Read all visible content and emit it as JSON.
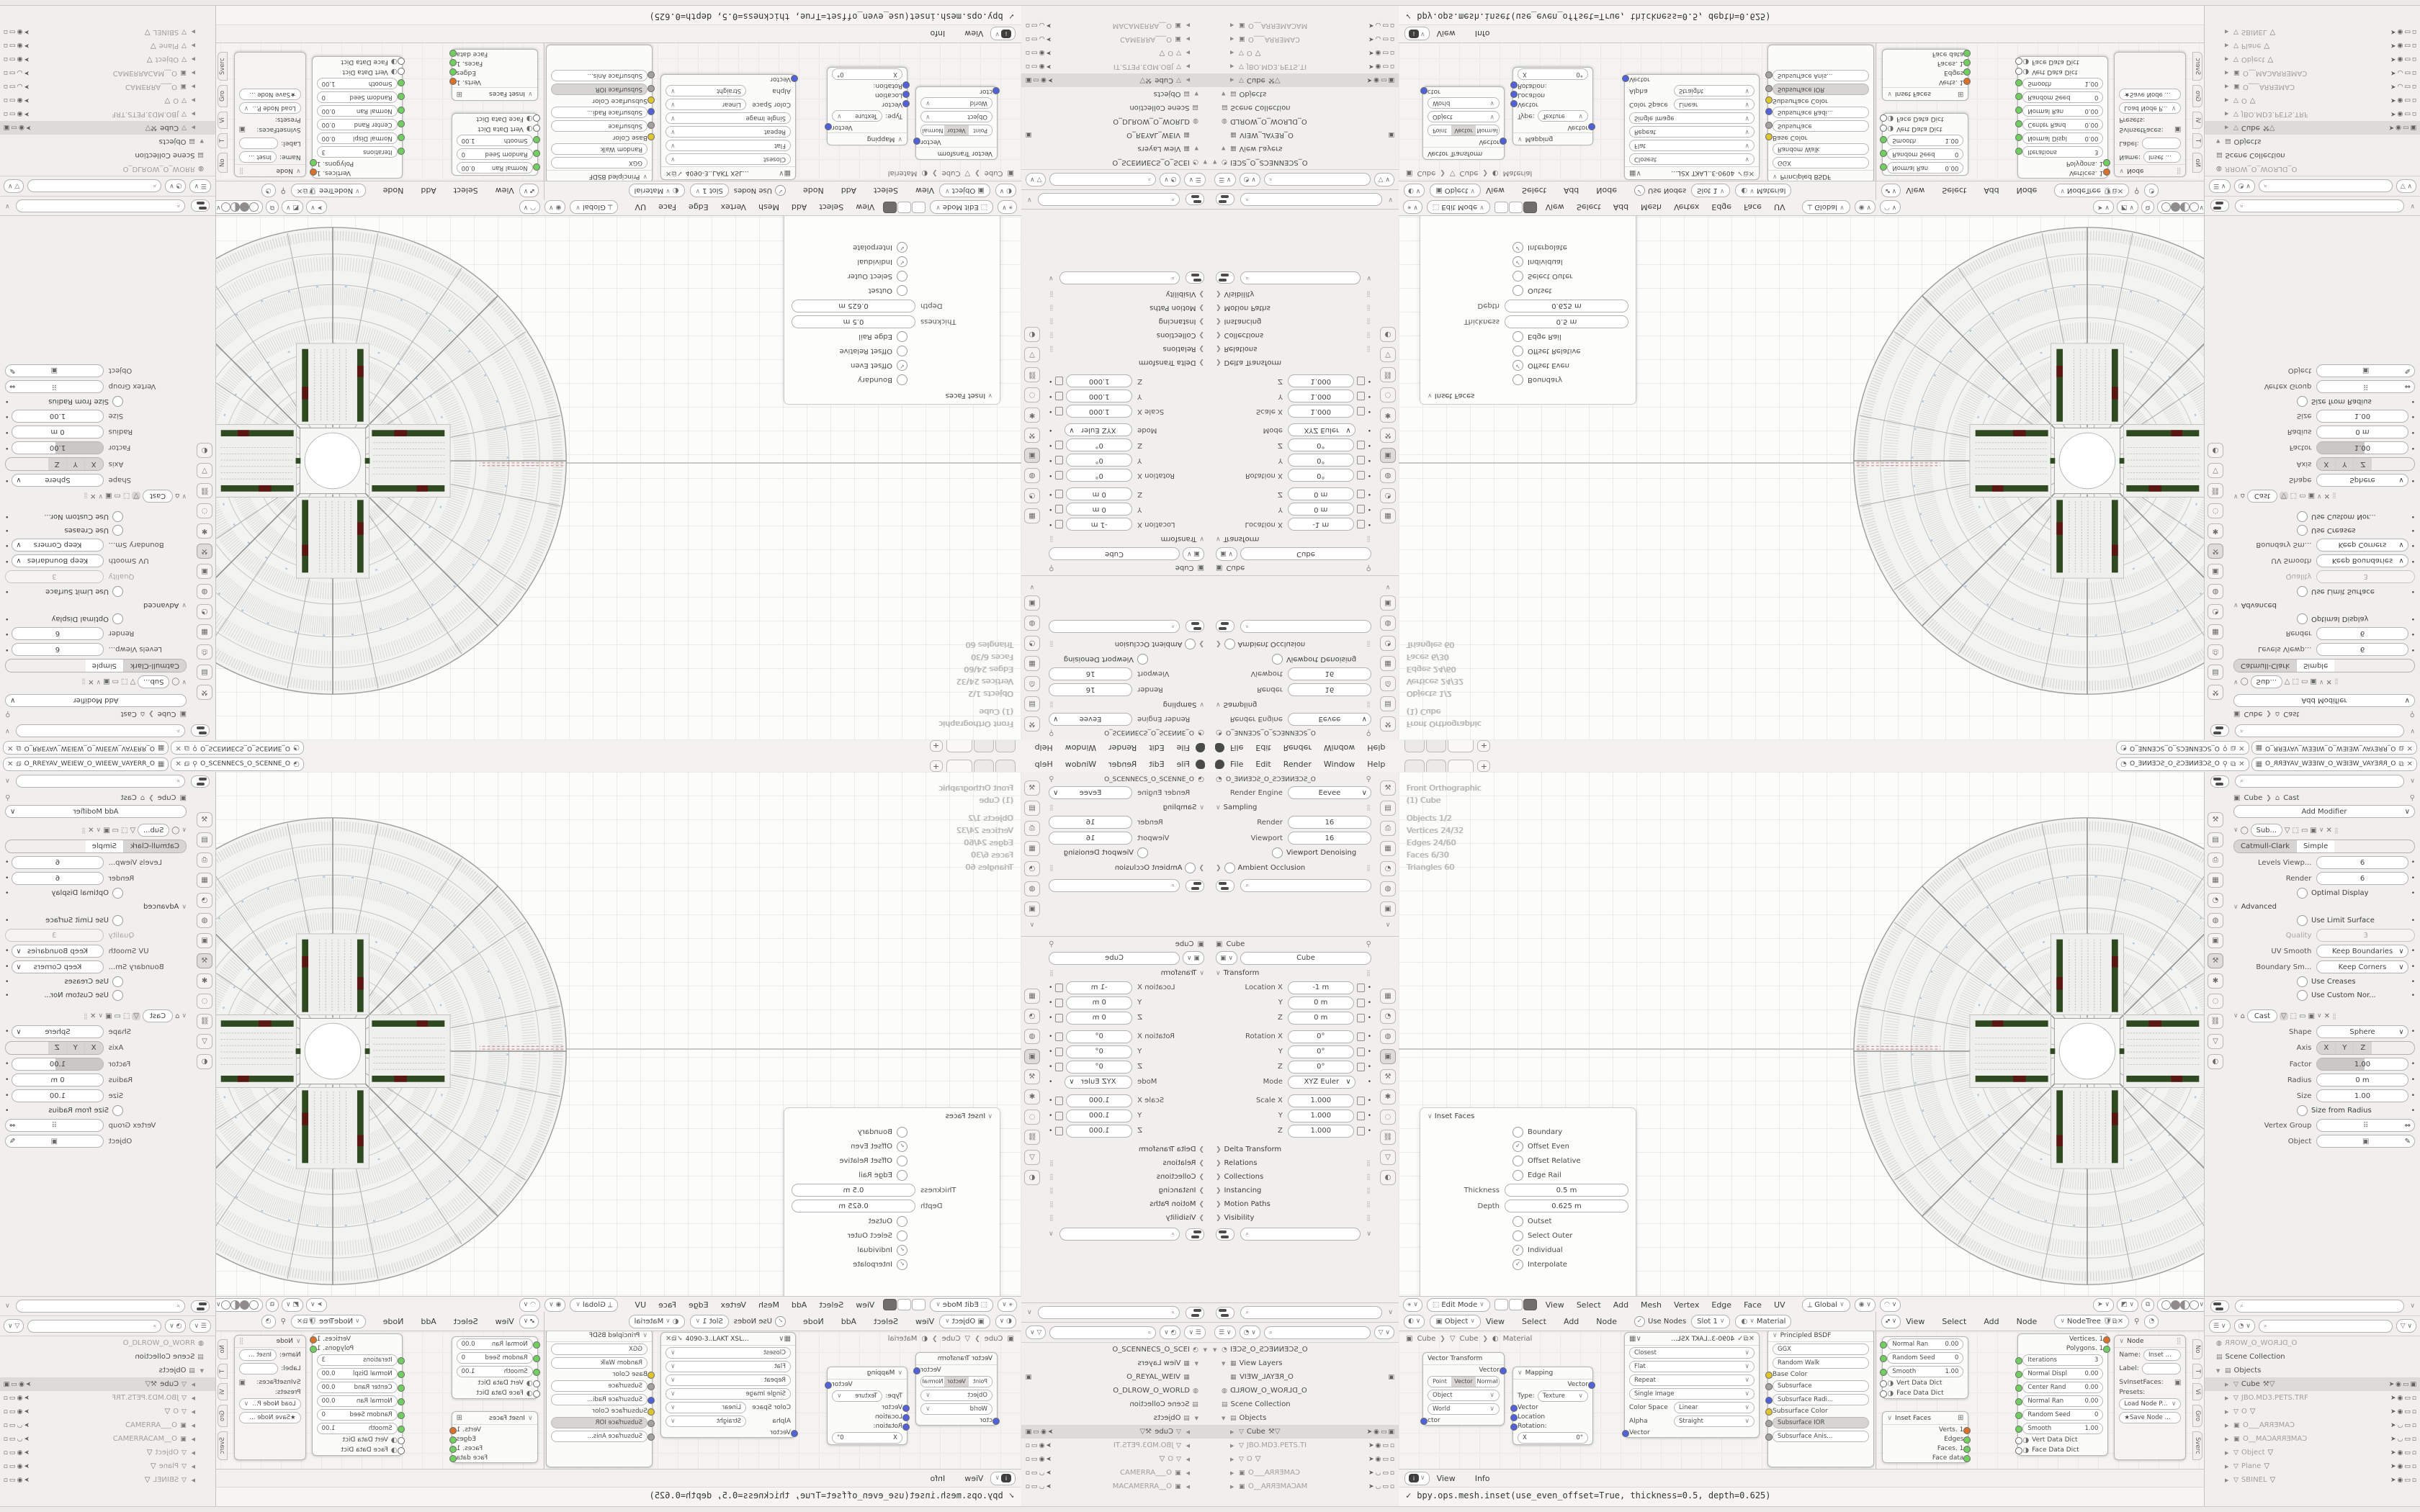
{
  "topbar": {
    "menus": [
      "File",
      "Edit",
      "Render",
      "Window",
      "Help"
    ],
    "tab_plus": "+",
    "scene_value": "O_SCENNECS_O_SCENNE_O",
    "viewlayer_value": "O_RREYAV_WEIEW_O_WIEEW_VAYERR_O"
  },
  "props_render": {
    "breadcrumb": "O_SCENNECS_O_SCENNE_O",
    "engine_label": "Render Engine",
    "engine": "Eevee",
    "sampling": "Sampling",
    "render_label": "Render",
    "render": "16",
    "viewport_label": "Viewport",
    "viewport": "16",
    "denoise": "Viewport Denoising",
    "ao": "Ambient Occlusion"
  },
  "props_object": {
    "breadcrumb": "Cube",
    "name": "Cube",
    "transform": "Transform",
    "rows": [
      {
        "label": "Location X",
        "value": "-1 m"
      },
      {
        "label": "Y",
        "value": "0 m"
      },
      {
        "label": "Z",
        "value": "0 m"
      },
      {
        "label": "Rotation X",
        "value": "0°"
      },
      {
        "label": "Y",
        "value": "0°"
      },
      {
        "label": "Z",
        "value": "0°"
      },
      {
        "label": "Mode",
        "value": "XYZ Euler"
      },
      {
        "label": "Scale X",
        "value": "1.000"
      },
      {
        "label": "Y",
        "value": "1.000"
      },
      {
        "label": "Z",
        "value": "1.000"
      }
    ],
    "collapsed": [
      "Delta Transform",
      "Relations",
      "Collections",
      "Instancing",
      "Motion Paths",
      "Visibility"
    ]
  },
  "outliner_left": {
    "root": "O_SCENNECS_O_SCEI",
    "view_layers": "View Layers",
    "viewlayer": "O_REYAL_WEIV",
    "world": "O_DLROW_O_WORLD",
    "scene_collection": "Scene Collection",
    "objects": "Objects",
    "rows": [
      {
        "name": "Cube"
      },
      {
        "name": "JBO.MD3.PETS.TI"
      },
      {
        "name": "O"
      },
      {
        "name": "CAMERRA___O"
      },
      {
        "name": "MACAMERRA__O"
      }
    ]
  },
  "outliner_right": {
    "world": "O_DLROW_O_WORR",
    "scene_collection": "Scene Collection",
    "objects": "Objects",
    "rows": [
      {
        "name": "Cube"
      },
      {
        "name": "JBO.MD3.PETS.TRF"
      },
      {
        "name": "O"
      },
      {
        "name": "CAMERRA___O"
      },
      {
        "name": "CAMERRACAM__O"
      },
      {
        "name": "Object"
      },
      {
        "name": "Plane"
      },
      {
        "name": "SBINEL"
      }
    ]
  },
  "viewport": {
    "stats": [
      "Front Orthographic",
      "(1) Cube",
      "Objects    1/2",
      "Vertices    24/32",
      "Edges    24/60",
      "Faces    6/30",
      "Triangles    60"
    ],
    "mode": "Edit Mode",
    "menus": [
      "View",
      "Select",
      "Add",
      "Mesh",
      "Vertex",
      "Edge",
      "Face",
      "UV"
    ],
    "orientation": "Global"
  },
  "inset_panel": {
    "title": "Inset Faces",
    "options": [
      "Boundary",
      "Offset Even",
      "Offset Relative",
      "Edge Rail"
    ],
    "thickness_label": "Thickness",
    "thickness": "0.5 m",
    "depth_label": "Depth",
    "depth": "0.625 m",
    "options2": [
      "Outset",
      "Select Outer",
      "Individual",
      "Interpolate"
    ]
  },
  "modifiers": {
    "breadcrumb_obj": "Cube",
    "breadcrumb_mod": "Cast",
    "add": "Add Modifier",
    "sub_name": "Sub...",
    "sub_type_a": "Catmull-Clark",
    "sub_type_b": "Simple",
    "levels_label": "Levels Viewp...",
    "levels": "6",
    "render_label": "Render",
    "render": "6",
    "optimal": "Optimal Display",
    "advanced": "Advanced",
    "use_limit": "Use Limit Surface",
    "quality_label": "Quality",
    "quality": "3",
    "uv_label": "UV Smooth",
    "uv": "Keep Boundaries",
    "bound_label": "Boundary Sm...",
    "bound": "Keep Corners",
    "creases": "Use Creases",
    "custom": "Use Custom Nor...",
    "cast_name": "Cast",
    "shape_label": "Shape",
    "shape": "Sphere",
    "axis_label": "Axis",
    "axis": [
      "X",
      "Y",
      "Z"
    ],
    "factor_label": "Factor",
    "factor": "1.00",
    "radius_label": "Radius",
    "radius": "0 m",
    "size_label": "Size",
    "size": "1.00",
    "size_from": "Size from Radius",
    "vgroup_label": "Vertex Group",
    "object_label": "Object"
  },
  "shader": {
    "type": "Object",
    "menus": [
      "View",
      "Select",
      "Add",
      "Node"
    ],
    "use_nodes": "Use Nodes",
    "slot": "Slot 1",
    "material": "Material",
    "crumb": [
      "Cube",
      "Cube",
      "Material"
    ],
    "vt": {
      "title": "Vector Transform",
      "out": "Vector",
      "seg": [
        "Point",
        "Vector",
        "Normal"
      ],
      "dd1": "Object",
      "dd2": "World",
      "in1": "ctor"
    },
    "map": {
      "title": "Mapping",
      "out": "Vector",
      "type_label": "Type:",
      "type": "Texture",
      "in1": "Vector",
      "in2": "Location",
      "in3": "Rotation:",
      "xv": "0°"
    },
    "img": {
      "name": "4090-3..LAKT XSL...",
      "f1": "Closest",
      "f2": "Flat",
      "f3": "Repeat",
      "f4": "Single Image",
      "cs_label": "Color Space",
      "cs": "Linear",
      "a_label": "Alpha",
      "a": "Straight",
      "in1": "Vector"
    },
    "bsdf": {
      "title": "Principled BSDF",
      "f1": "GGX",
      "f2": "Random Walk",
      "s1": "Base Color",
      "s2": "Subsurface",
      "s3": "Subsurface Radi...",
      "s4": "Subsurface Color",
      "s5": "Subsurface IOR",
      "s6": "Subsurface Anis..."
    }
  },
  "geo": {
    "menus": [
      "View",
      "Select",
      "Add",
      "Node"
    ],
    "tree": "NodeTree",
    "small": {
      "r1": "Normal Ran",
      "v1": "0.00",
      "r2": "Random Seed",
      "v2": "0",
      "r3": "Smooth",
      "v3": "1.00",
      "d1": "Vert Data Dict",
      "d2": "Face Data Dict"
    },
    "inset": {
      "title": "Inset Faces",
      "o1": "Verts. 1",
      "o2": "Edges",
      "o3": "Faces. 1",
      "o4": "Face data"
    },
    "big": {
      "out1": "Vertices. 1",
      "out2": "Polygons. 1",
      "r1": "Iterations",
      "v1": "3",
      "r2": "Normal Displ",
      "v2": "0.00",
      "r3": "Center Rand",
      "v3": "0.00",
      "r4": "Normal Ran",
      "v4": "0.00",
      "r5": "Random Seed",
      "v5": "0",
      "r6": "Smooth",
      "v6": "1.00",
      "d1": "Vert Data Dict",
      "d2": "Face Data Dict"
    },
    "npanel": {
      "title": "Node",
      "name_label": "Name:",
      "name": "Inset ...",
      "label_label": "Label:",
      "sv": "SvInsetFaces:",
      "presets": "Presets:",
      "load": "Load Node P...",
      "save": "Save Node ...",
      "tabs": [
        "No",
        "T",
        "Vi",
        "Gro",
        "Sverc"
      ]
    }
  },
  "info": {
    "view": "View",
    "info": "Info",
    "log": "bpy.ops.mesh.inset(use_even_offset=True, thickness=0.5, depth=0.625)"
  },
  "colors": {
    "accent_green": "#2f4a21",
    "accent_maroon": "#5a1612",
    "accent_blue": "#a9c7e8",
    "socket_yellow": "#dcc52f",
    "socket_blue": "#5161d8",
    "socket_green": "#6fcf5f",
    "socket_orange": "#d8722a"
  }
}
